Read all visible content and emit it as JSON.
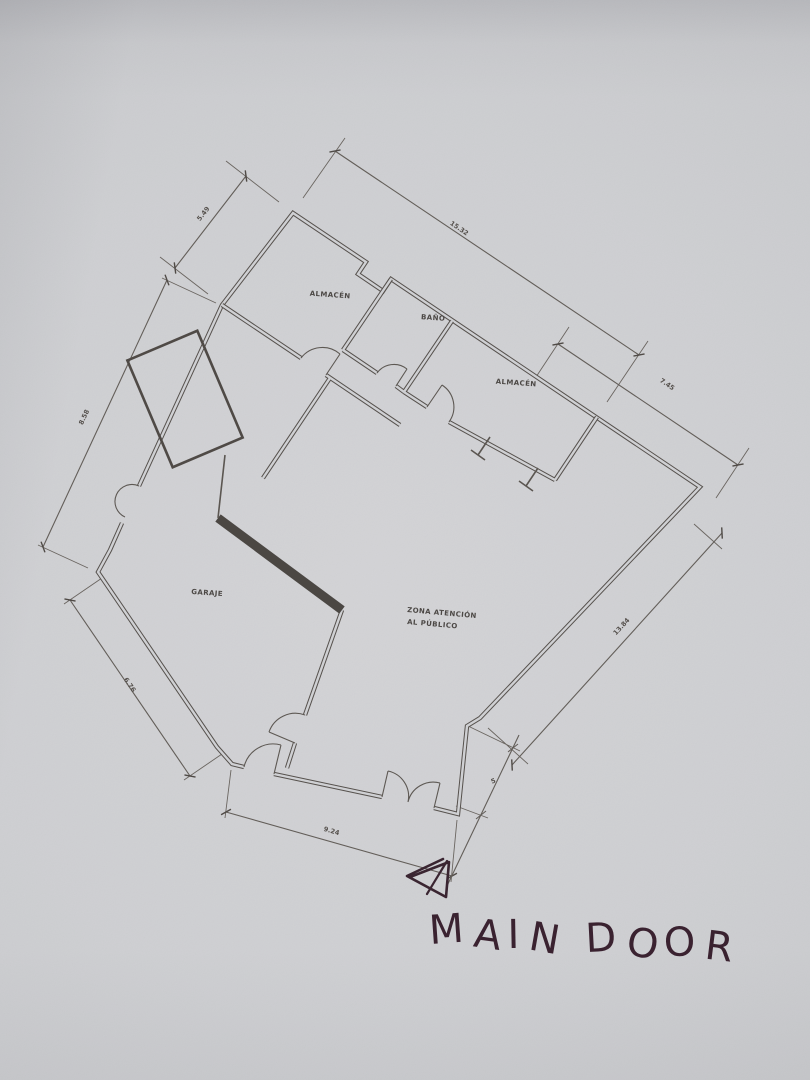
{
  "photo": {
    "paper_hex": "#cfd0d3",
    "cad_line_hex": "#56514d",
    "ink_hex": "#3a2230"
  },
  "floor_plan": {
    "rooms": [
      {
        "name": "almacen-1",
        "label": "ALMACÉN"
      },
      {
        "name": "bano",
        "label": "BAÑO"
      },
      {
        "name": "almacen-2",
        "label": "ALMACÉN"
      },
      {
        "name": "garaje",
        "label": "GARAJE"
      },
      {
        "name": "zona-atencion",
        "label_line1": "ZONA ATENCIÓN",
        "label_line2": "AL PÚBLICO"
      }
    ],
    "dimensions": {
      "top_left": "5.49",
      "top": "15.32",
      "upper_right": "7.45",
      "left": "8.58",
      "lower_left": "6.76",
      "bottom": "9.24",
      "bottom_right": "5",
      "right": "13.84"
    }
  },
  "annotation": {
    "label": "MAIN DOOR"
  }
}
